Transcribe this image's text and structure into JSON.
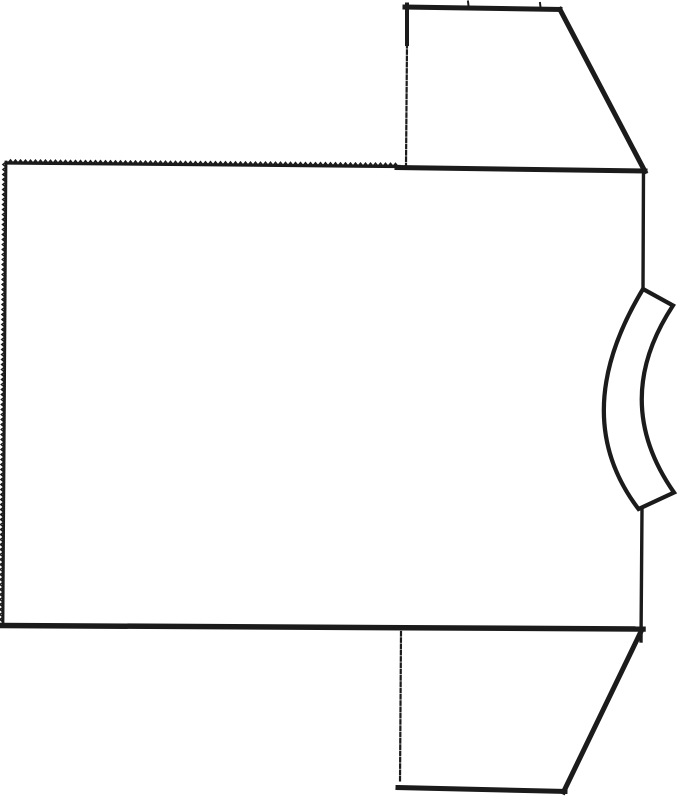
{
  "figure": {
    "kind": "t-shirt-outline-line-drawing",
    "orientation": "rotated-90-neckband-on-right",
    "background": "#ffffff",
    "ink": "#1b1b1b"
  },
  "canvas": {
    "width": 687,
    "height": 800
  },
  "drawing": {
    "elements": [
      {
        "type": "polygon",
        "name": "body-panel",
        "points": "8,161 644,171.5 642,629 3,624",
        "fill": "#ffffff"
      },
      {
        "type": "polygon",
        "name": "sleeve-top-panel",
        "points": "407,6 560,9 644,170 407,167",
        "fill": "#ffffff"
      },
      {
        "type": "polygon",
        "name": "sleeve-bottom-panel",
        "points": "401,632 640,633 564,791 400,787",
        "fill": "#ffffff"
      },
      {
        "type": "path",
        "name": "neckband",
        "d": "M 643,289 L 673,305.5 Q 610,401 674,492.5 L 638.5,509 Q 567,415 643,289 Z",
        "width": 4.2,
        "fill": "#ffffff"
      },
      {
        "type": "zigzag",
        "name": "body-top-serrated-edge",
        "x1": 8,
        "y1": 163,
        "x2": 399,
        "y2": 166.5,
        "tooth_w": 5,
        "tooth_h": 3,
        "base_width": 3.2
      },
      {
        "type": "zigzag",
        "name": "body-left-serrated-edge",
        "x1": 3,
        "y1": 622,
        "x2": 6,
        "y2": 162,
        "tooth_w": 5,
        "tooth_h": 3,
        "base_width": 2.8
      },
      {
        "type": "path",
        "name": "shoulder-seam-edge",
        "d": "M 397,167.5 L 645,171",
        "width": 5
      },
      {
        "type": "path",
        "name": "body-bottom-edge",
        "d": "M 2,625.5 L 643,629",
        "width": 5.5
      },
      {
        "type": "path",
        "name": "armhole-upper-edge",
        "d": "M 643.5,169.5 L 643,290",
        "width": 3.4
      },
      {
        "type": "path",
        "name": "armhole-lower-edge",
        "d": "M 642,510 L 641,641",
        "width": 3.4
      },
      {
        "type": "path",
        "name": "sleeve-top-left-edge-solid",
        "d": "M 407,4.5 L 407,44",
        "width": 4
      },
      {
        "type": "path",
        "name": "sleeve-top-left-edge-dashed",
        "d": "M 407,44 L 406,166",
        "width": 2.2,
        "dash": "3.5,2.8"
      },
      {
        "type": "path",
        "name": "sleeve-top-cap-edge",
        "d": "M 405,7 L 560,9.5",
        "width": 5
      },
      {
        "type": "path",
        "name": "sleeve-top-slant-edge",
        "d": "M 560,9.5 L 645,171.5",
        "width": 5
      },
      {
        "type": "path",
        "name": "sleeve-top-notch-1",
        "d": "M 468,1.5 L 468.6,6.5",
        "width": 2
      },
      {
        "type": "path",
        "name": "sleeve-top-notch-2",
        "d": "M 540,3 L 540.6,8",
        "width": 2
      },
      {
        "type": "path",
        "name": "sleeve-bottom-left-edge-dashed",
        "d": "M 401,632 L 400,783",
        "width": 2.2,
        "dash": "3.5,2.8"
      },
      {
        "type": "path",
        "name": "sleeve-bottom-cap-edge",
        "d": "M 398,787.5 L 565,791.5",
        "width": 5
      },
      {
        "type": "path",
        "name": "sleeve-bottom-slant-edge",
        "d": "M 640.5,632.5 L 563.5,792",
        "width": 5
      }
    ]
  }
}
